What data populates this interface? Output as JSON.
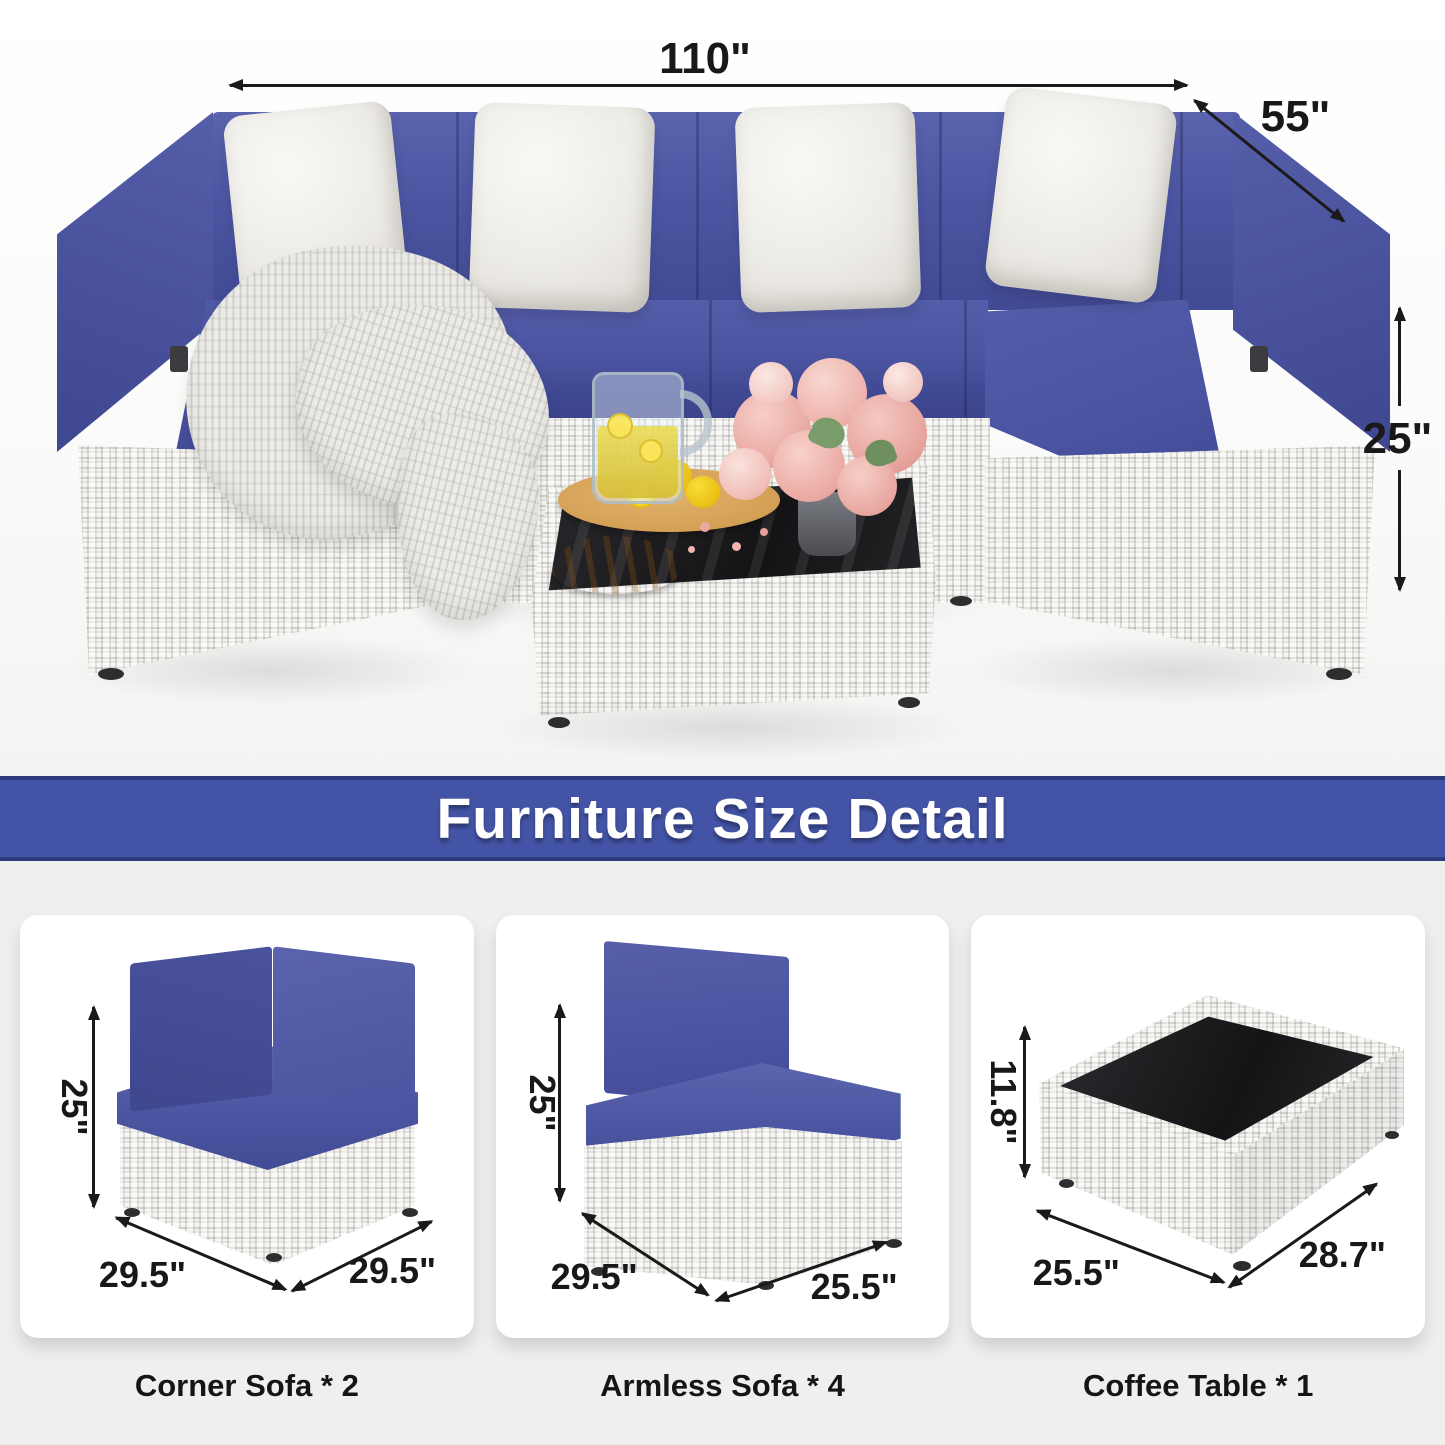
{
  "hero": {
    "width_label": "110\"",
    "depth_label": "55\"",
    "height_label": "25\""
  },
  "banner": {
    "title": "Furniture Size Detail"
  },
  "cards": [
    {
      "caption": "Corner Sofa * 2",
      "height": "25\"",
      "dim_left": "29.5\"",
      "dim_right": "29.5\""
    },
    {
      "caption": "Armless Sofa * 4",
      "height": "25\"",
      "dim_left": "29.5\"",
      "dim_right": "25.5\""
    },
    {
      "caption": "Coffee Table * 1",
      "height": "11.8\"",
      "dim_left": "25.5\"",
      "dim_right": "28.7\""
    }
  ],
  "colors": {
    "banner_blue": "#4353a5",
    "banner_border": "#2e3a7e",
    "cushion_navy": "#4c55a1",
    "bottom_bg": "#efefee",
    "card_bg": "#ffffff",
    "annotation": "#1a1a1a"
  }
}
